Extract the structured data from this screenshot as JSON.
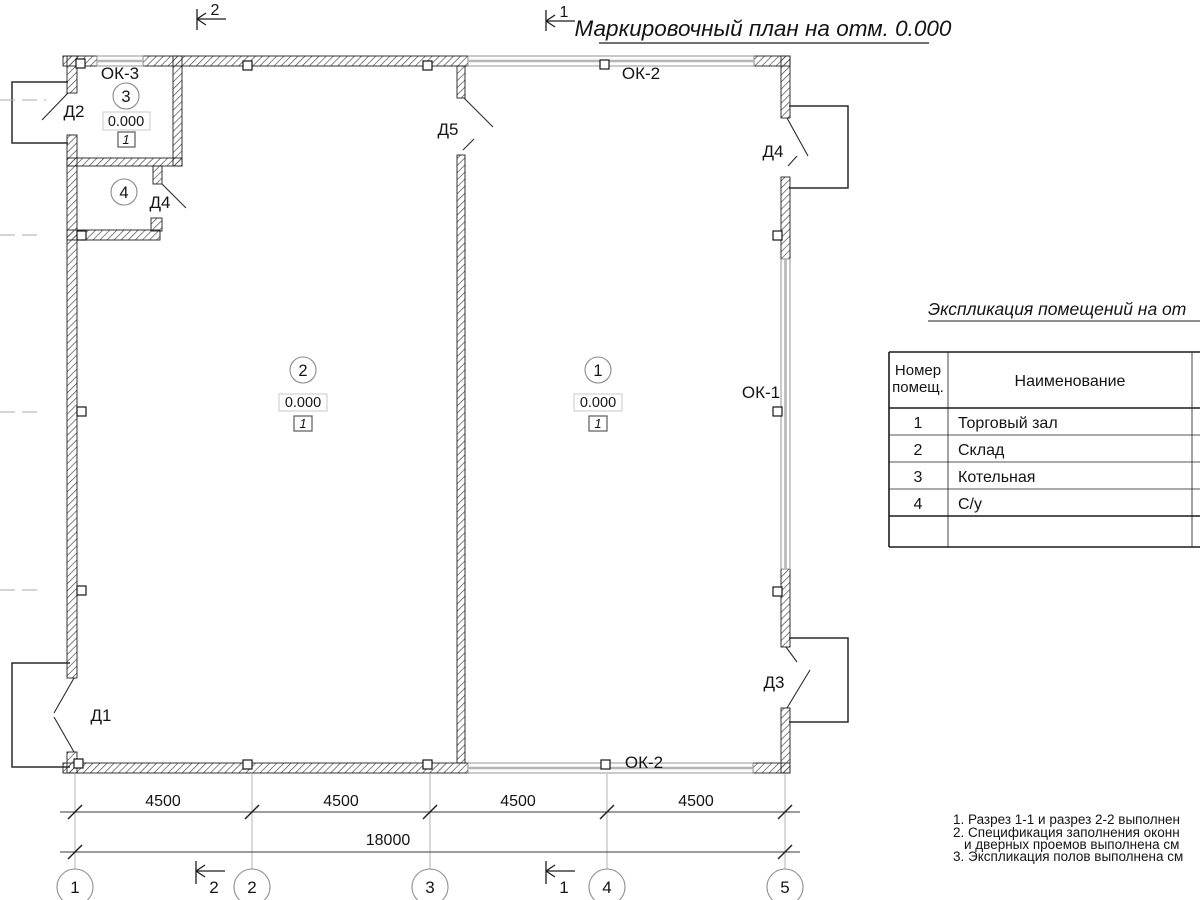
{
  "title": {
    "text": "Маркировочный план на отм. 0.000"
  },
  "sections": {
    "s1": "1",
    "s2": "2"
  },
  "grid_axes": [
    "1",
    "2",
    "3",
    "4",
    "5"
  ],
  "dimensions": {
    "bay": "4500",
    "total": "18000"
  },
  "plan": {
    "rooms": [
      {
        "number": "1",
        "elevation": "0.000",
        "floor": "1"
      },
      {
        "number": "2",
        "elevation": "0.000",
        "floor": "1"
      },
      {
        "number": "3",
        "elevation": "0.000",
        "floor": "1"
      },
      {
        "number": "4"
      }
    ],
    "doors": {
      "d1": "Д1",
      "d2": "Д2",
      "d3": "Д3",
      "d4": "Д4",
      "d5": "Д5"
    },
    "windows": {
      "ok1": "ОК-1",
      "ok2": "ОК-2",
      "ok3": "ОК-3"
    }
  },
  "legend_table": {
    "title": "Экспликация помещений на от",
    "header": {
      "col1_line1": "Номер",
      "col1_line2": "помещ.",
      "col2": "Наименование"
    },
    "rows": [
      {
        "num": "1",
        "name": "Торговый зал"
      },
      {
        "num": "2",
        "name": "Склад"
      },
      {
        "num": "3",
        "name": "Котельная"
      },
      {
        "num": "4",
        "name": "С/у"
      }
    ]
  },
  "notes": [
    "1. Разрез 1-1 и разрез 2-2 выполнен",
    "2. Спецификация заполнения оконн",
    "и дверных проемов выполнена см",
    "3. Экспликация полов выполнена см"
  ],
  "colors": {
    "line": "#1c1c1c",
    "aux": "#b3b3b3",
    "hatch": "#3f3f3f",
    "window_band": "#b5b5b5"
  }
}
